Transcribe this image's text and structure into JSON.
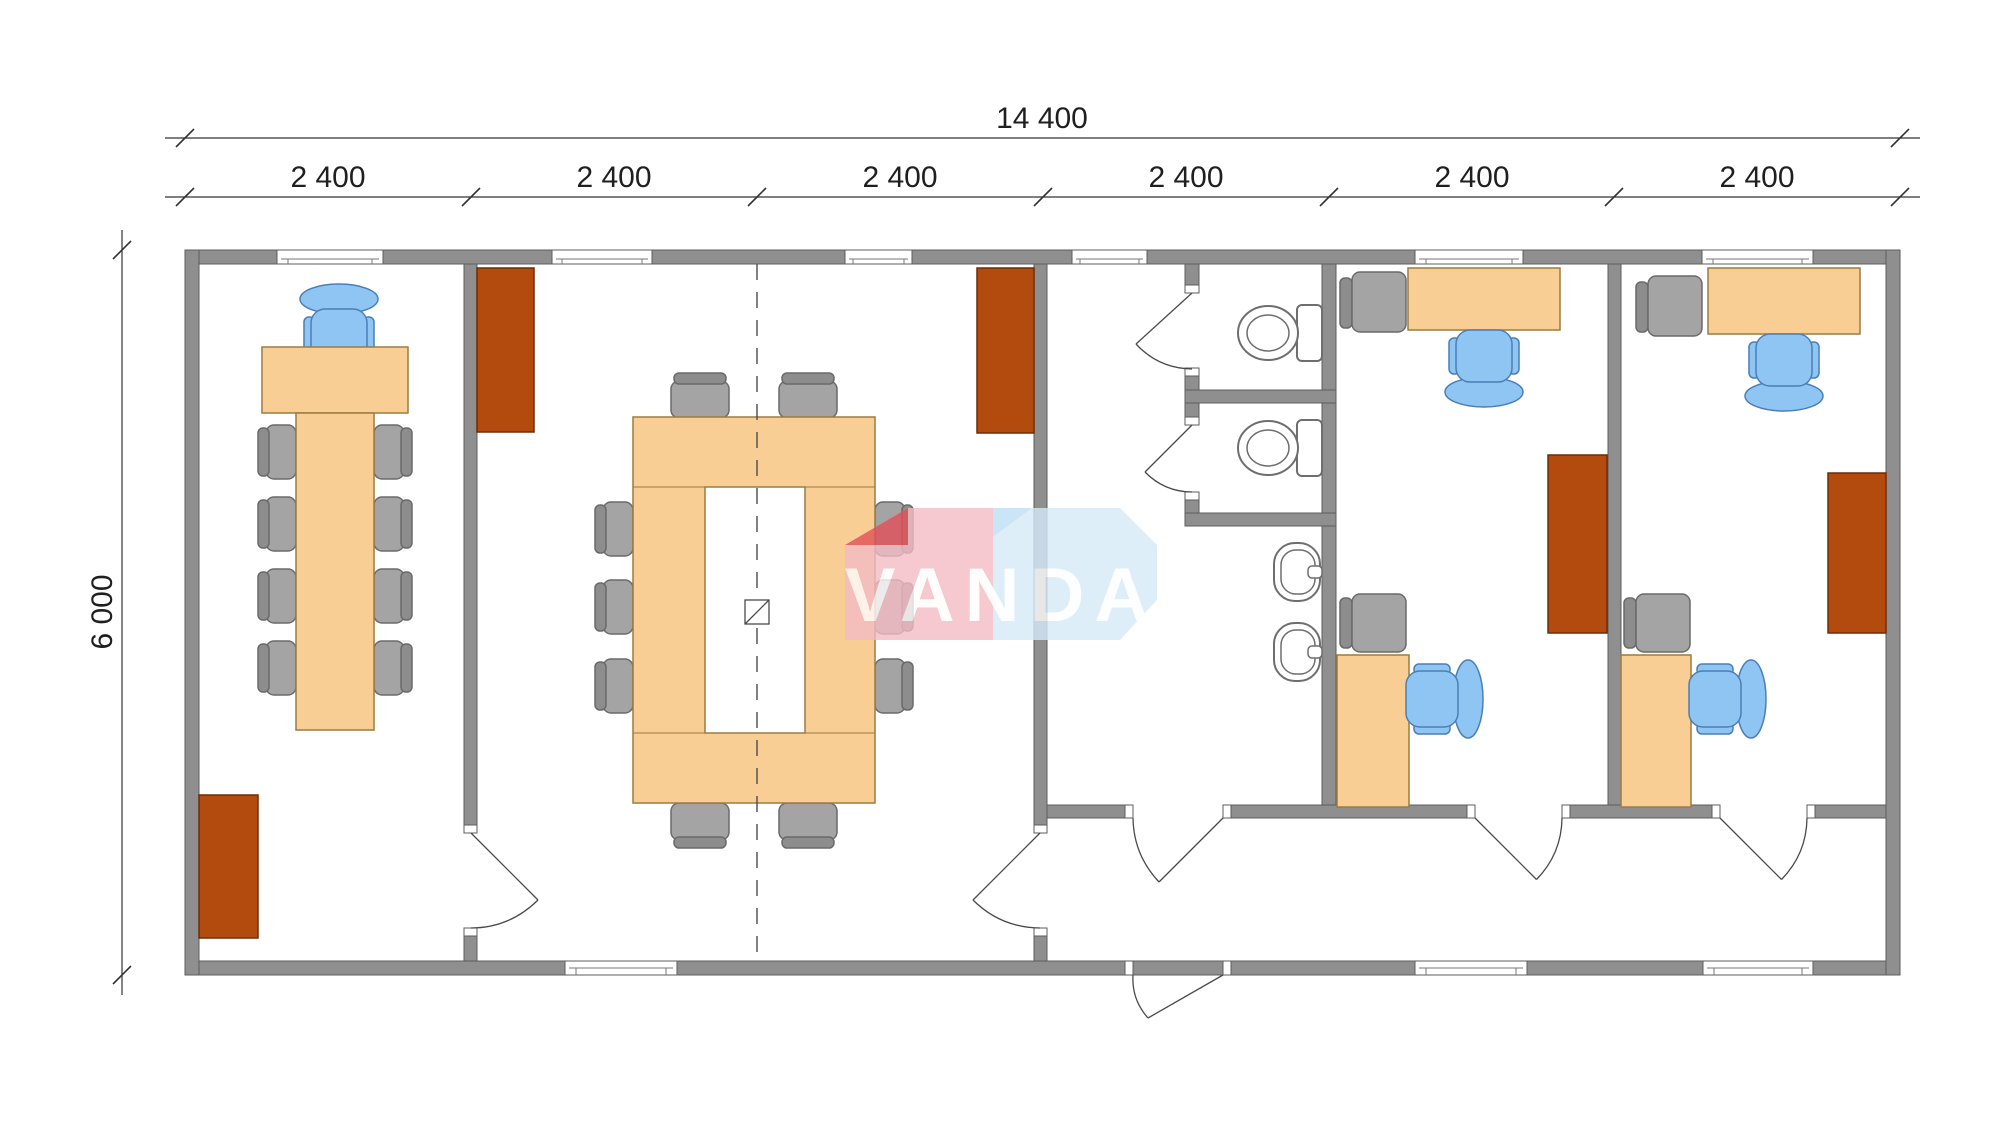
{
  "dimensions": {
    "total_width": "14 400",
    "modules": [
      "2 400",
      "2 400",
      "2 400",
      "2 400",
      "2 400",
      "2 400"
    ],
    "height": "6 000"
  },
  "watermark": {
    "text": "VANDA",
    "pink": "#F4BBC4",
    "red_fold": "#E25058",
    "blue": "#D6EAF8",
    "blue_fold": "#BEDFF3",
    "text_color": "#FFFFFF"
  },
  "colors": {
    "background": "#FFFFFF",
    "wall": "#8F8F8F",
    "wall_outline": "#5E5E5E",
    "desk": "#F9CE95",
    "desk_outline": "#9C7B42",
    "cabinet": "#B34B0E",
    "chair_gray": "#A4A4A4",
    "chair_blue": "#8FC5F2",
    "sanitary": "#FFFFFF",
    "dimension_line": "#333333",
    "module_joint_line": "#4A4A4A"
  }
}
